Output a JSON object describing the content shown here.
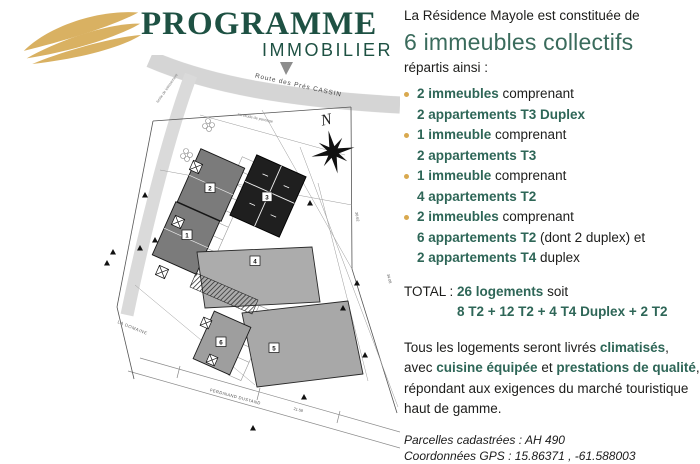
{
  "brand": {
    "title": "PROGRAMME",
    "subtitle": "IMMOBILIER",
    "logo": "gold-waves-icon",
    "green": "#1e5143",
    "gold": "#d9b162"
  },
  "colors": {
    "teal_strong": "#2e6657",
    "teal_heading": "#3a6b5c",
    "text_dark": "#1d1d1b",
    "bullet_gold": "#d9a94f"
  },
  "intro": {
    "line1": "La Résidence Mayole est constituée de",
    "headline": "6 immeubles collectifs",
    "line2": "répartis ainsi :"
  },
  "list": [
    {
      "bullet": true,
      "segments": [
        {
          "t": "2 immeubles",
          "s": "strong"
        },
        {
          "t": " comprenant",
          "s": "normal"
        }
      ]
    },
    {
      "bullet": false,
      "segments": [
        {
          "t": "2 appartements T3 Duplex",
          "s": "strong"
        }
      ]
    },
    {
      "bullet": true,
      "segments": [
        {
          "t": "1 immeuble",
          "s": "strong"
        },
        {
          "t": " comprenant",
          "s": "normal"
        }
      ]
    },
    {
      "bullet": false,
      "segments": [
        {
          "t": "2 appartements T3",
          "s": "strong"
        }
      ]
    },
    {
      "bullet": true,
      "segments": [
        {
          "t": "1 immeuble",
          "s": "strong"
        },
        {
          "t": " comprenant",
          "s": "normal"
        }
      ]
    },
    {
      "bullet": false,
      "segments": [
        {
          "t": "4 appartements T2",
          "s": "strong"
        }
      ]
    },
    {
      "bullet": true,
      "segments": [
        {
          "t": "2 immeubles",
          "s": "strong"
        },
        {
          "t": " comprenant",
          "s": "normal"
        }
      ]
    },
    {
      "bullet": false,
      "segments": [
        {
          "t": "6 appartements T2",
          "s": "strong"
        },
        {
          "t": " (dont 2 duplex) et",
          "s": "normal"
        }
      ]
    },
    {
      "bullet": false,
      "segments": [
        {
          "t": "2 appartements T4",
          "s": "strong"
        },
        {
          "t": " duplex",
          "s": "normal"
        }
      ]
    }
  ],
  "total": {
    "label": "TOTAL :",
    "count": "26 logements",
    "suffix": "soit",
    "detail": "8 T2 + 12 T2 + 4 T4 Duplex + 2 T2"
  },
  "description": [
    [
      {
        "t": "Tous les logements seront livrés ",
        "s": "normal"
      },
      {
        "t": "climatisés",
        "s": "strong"
      },
      {
        "t": ",",
        "s": "normal"
      }
    ],
    [
      {
        "t": "avec ",
        "s": "normal"
      },
      {
        "t": "cuisine équipée",
        "s": "strong"
      },
      {
        "t": " et ",
        "s": "normal"
      },
      {
        "t": "prestations de qualité",
        "s": "strong"
      },
      {
        "t": ",",
        "s": "normal"
      }
    ],
    [
      {
        "t": "répondant aux exigences du marché touristique",
        "s": "normal"
      }
    ],
    [
      {
        "t": "haut de gamme.",
        "s": "normal"
      }
    ]
  ],
  "footnote": {
    "line1": "Parcelles cadastrées : AH 490",
    "line2": "Coordonnées GPS : 15.86371 , -61.588003"
  },
  "plan": {
    "north_label": "N",
    "road_top_label": "Route des Prés CASSIN",
    "road_bottom_label": "FERDINAND DUSTAND",
    "area_label": "LA DOMAINE",
    "note1": "limite de lotissement",
    "note2": "servitude de passage",
    "dim1": "34.08",
    "dim2": "21.58",
    "dim3": "30.62",
    "buildings": [
      {
        "label": "1"
      },
      {
        "label": "2"
      },
      {
        "label": "3"
      },
      {
        "label": "4"
      },
      {
        "label": "5"
      },
      {
        "label": "6"
      }
    ]
  }
}
